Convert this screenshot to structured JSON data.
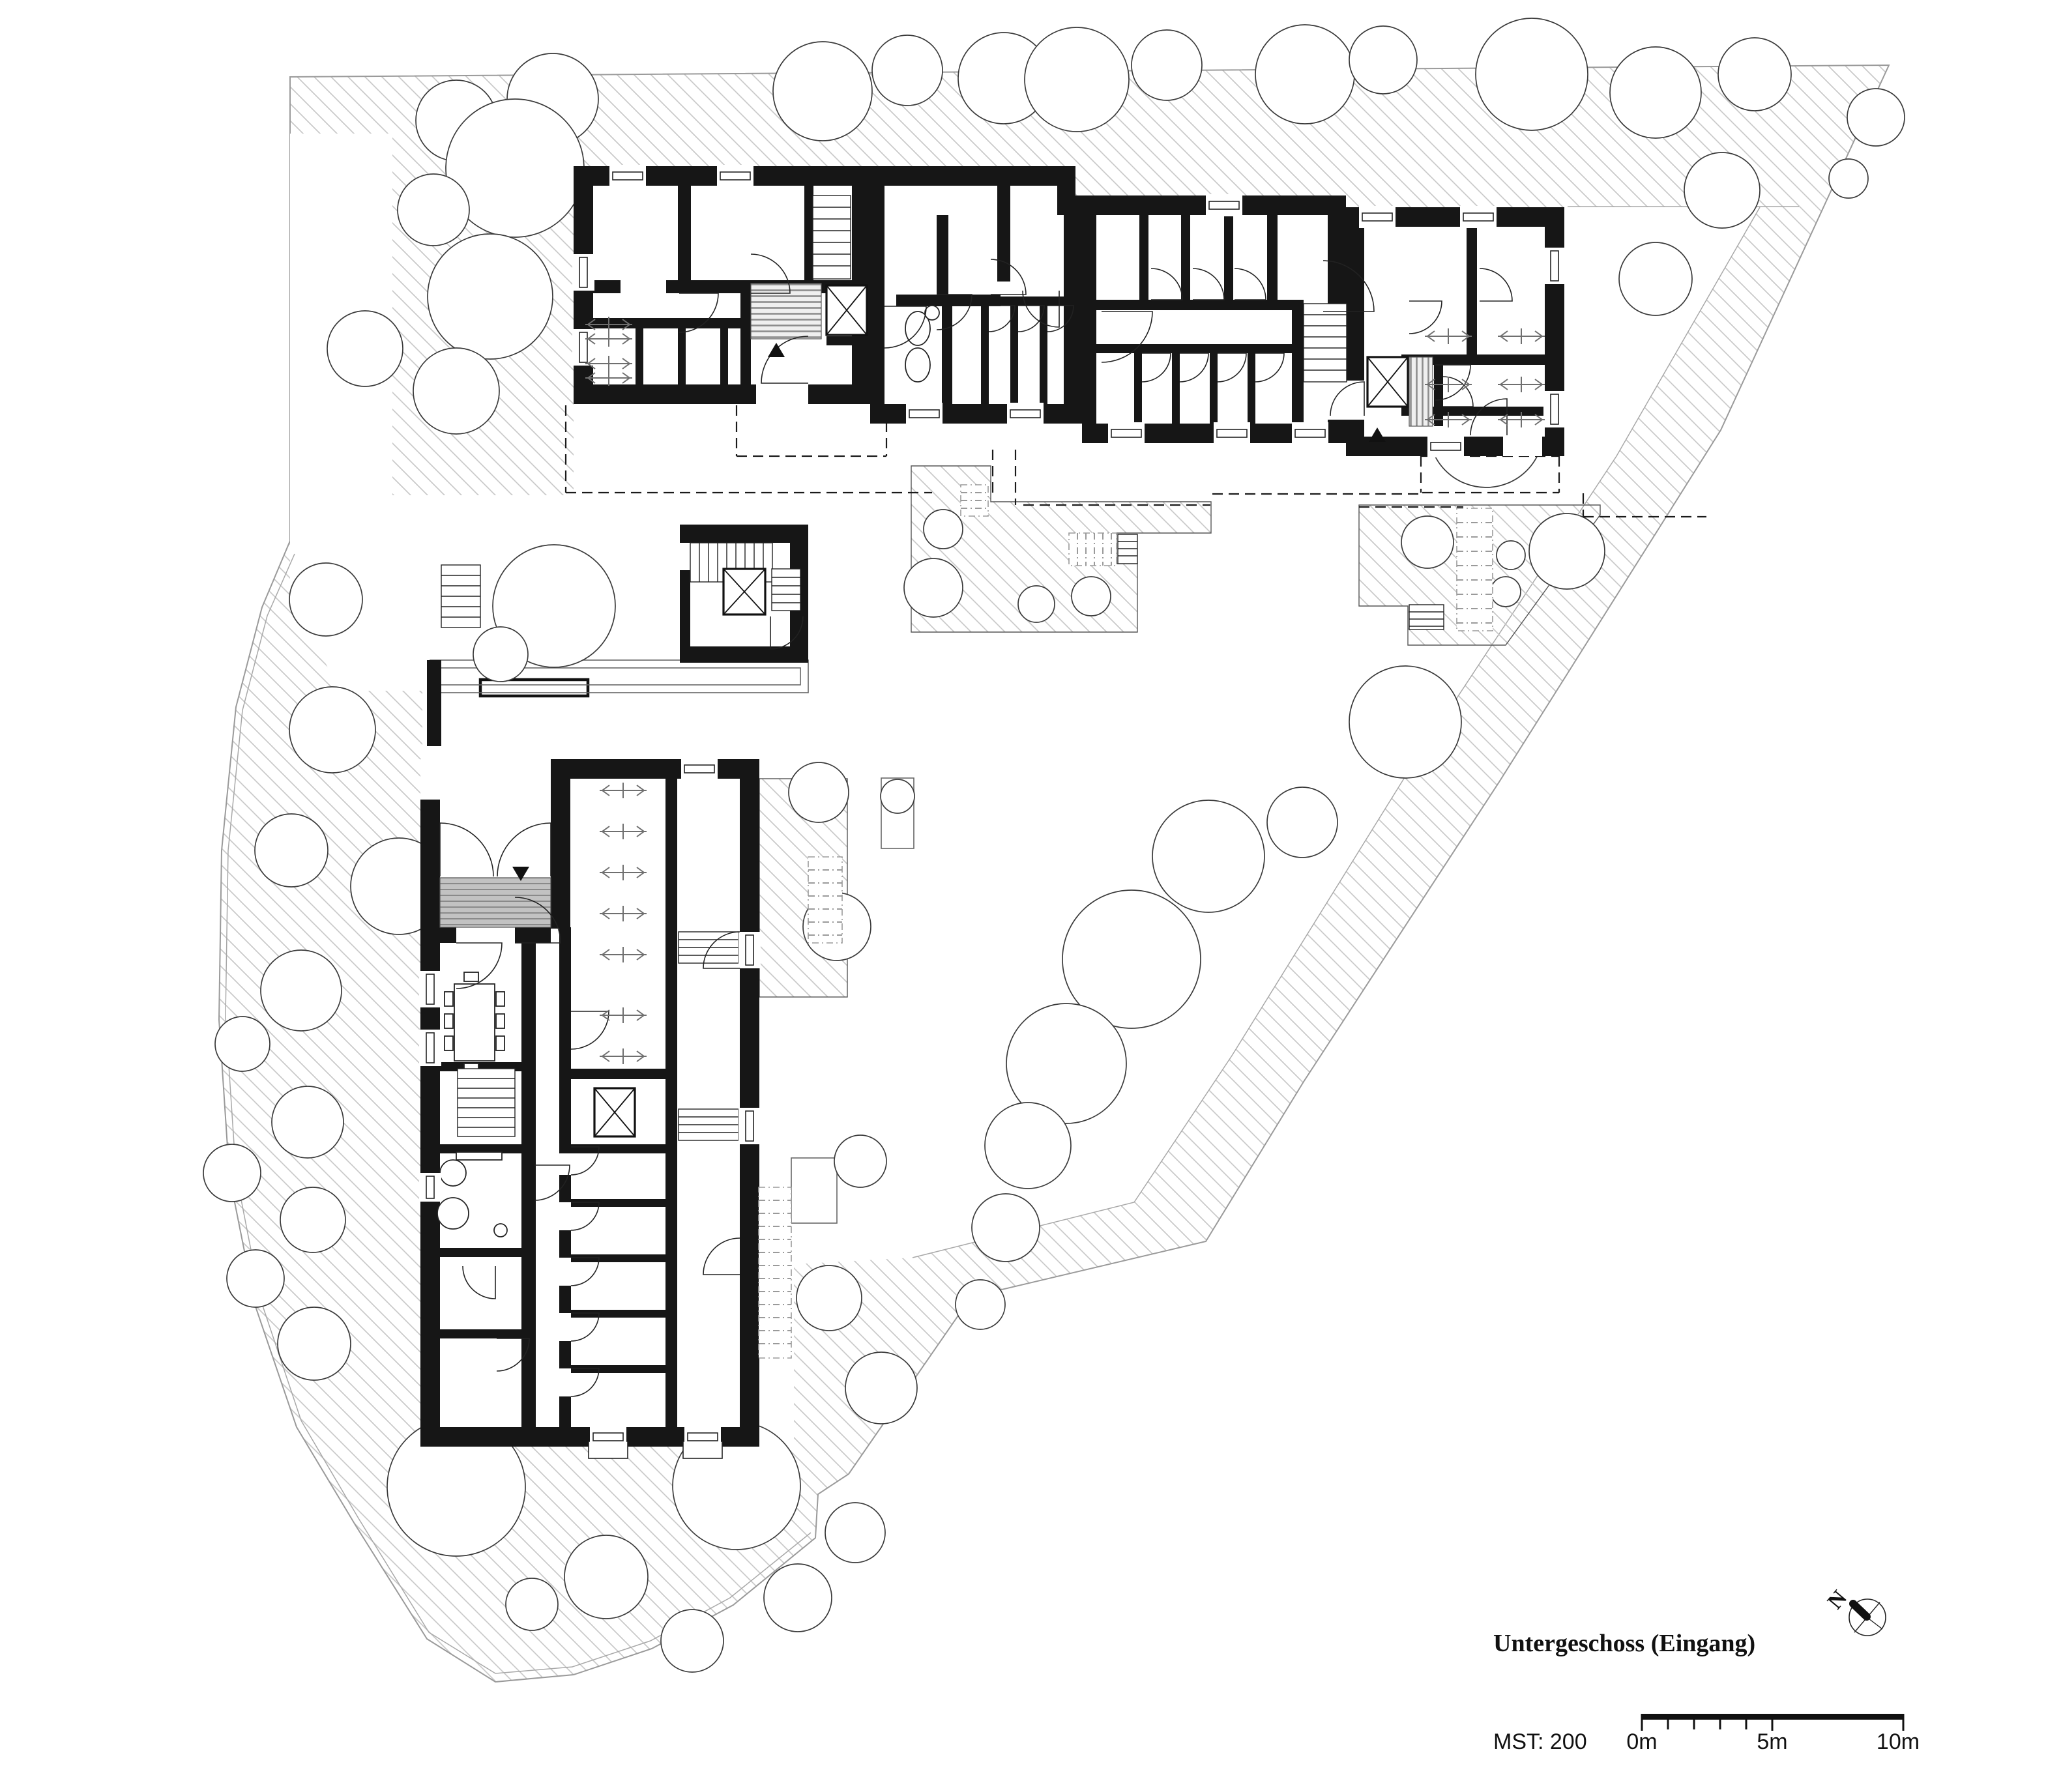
{
  "labels": {
    "floor_title": "Untergeschoss (Eingang)",
    "scale_label": "MST: 200",
    "scale_ticks": [
      "0m",
      "5m",
      "10m"
    ],
    "north_letter": "N"
  },
  "colors": {
    "walls": "#161616",
    "hatch_lines": "#c9c9c9",
    "site_boundary": "#9a9a9a",
    "gray_fill": "#c2c2c2",
    "dashdot_gray": "#9a9a9a",
    "background": "#ffffff"
  },
  "plan": {
    "trees": [
      [
        700,
        185,
        62
      ],
      [
        848,
        152,
        70
      ],
      [
        790,
        258,
        106
      ],
      [
        665,
        322,
        55
      ],
      [
        752,
        455,
        96
      ],
      [
        700,
        600,
        66
      ],
      [
        560,
        535,
        58
      ],
      [
        500,
        920,
        56
      ],
      [
        850,
        930,
        94
      ],
      [
        768,
        1004,
        42
      ],
      [
        1262,
        140,
        76
      ],
      [
        1392,
        108,
        54
      ],
      [
        1540,
        120,
        70
      ],
      [
        1652,
        122,
        80
      ],
      [
        1790,
        100,
        54
      ],
      [
        2002,
        114,
        76
      ],
      [
        2122,
        92,
        52
      ],
      [
        2350,
        114,
        86
      ],
      [
        2540,
        142,
        70
      ],
      [
        2692,
        114,
        56
      ],
      [
        2878,
        180,
        44
      ],
      [
        2836,
        274,
        30
      ],
      [
        510,
        1120,
        66
      ],
      [
        447,
        1305,
        56
      ],
      [
        612,
        1360,
        74
      ],
      [
        462,
        1520,
        62
      ],
      [
        372,
        1602,
        42
      ],
      [
        472,
        1722,
        55
      ],
      [
        356,
        1800,
        44
      ],
      [
        480,
        1872,
        50
      ],
      [
        392,
        1962,
        44
      ],
      [
        482,
        2062,
        56
      ],
      [
        700,
        2282,
        106
      ],
      [
        930,
        2420,
        64
      ],
      [
        816,
        2462,
        40
      ],
      [
        1062,
        2518,
        48
      ],
      [
        1130,
        2280,
        98
      ],
      [
        1224,
        2452,
        52
      ],
      [
        1312,
        2352,
        46
      ],
      [
        1256,
        1216,
        46
      ],
      [
        1284,
        1422,
        52
      ],
      [
        1377,
        1222,
        26
      ],
      [
        1320,
        1782,
        40
      ],
      [
        1272,
        1992,
        50
      ],
      [
        1352,
        2130,
        55
      ],
      [
        2156,
        1108,
        86
      ],
      [
        1998,
        1262,
        54
      ],
      [
        1854,
        1314,
        86
      ],
      [
        1736,
        1472,
        106
      ],
      [
        1636,
        1632,
        92
      ],
      [
        1577,
        1758,
        66
      ],
      [
        1543,
        1884,
        52
      ],
      [
        1504,
        2002,
        38
      ],
      [
        2540,
        428,
        56
      ],
      [
        2642,
        292,
        58
      ],
      [
        2280,
        660,
        88
      ],
      [
        1447,
        812,
        30
      ],
      [
        1432,
        902,
        45
      ],
      [
        1590,
        927,
        28
      ],
      [
        1674,
        915,
        30
      ],
      [
        2190,
        832,
        40
      ],
      [
        2318,
        852,
        22
      ],
      [
        2310,
        908,
        23
      ],
      [
        2404,
        846,
        58
      ]
    ],
    "windows": [
      [
        935,
        255,
        56,
        0
      ],
      [
        1100,
        255,
        56,
        0
      ],
      [
        1850,
        300,
        56,
        0
      ],
      [
        2085,
        318,
        56,
        0
      ],
      [
        2240,
        318,
        56,
        0
      ],
      [
        1390,
        620,
        56,
        0
      ],
      [
        1545,
        620,
        56,
        0
      ],
      [
        1700,
        650,
        56,
        0
      ],
      [
        1862,
        650,
        56,
        0
      ],
      [
        1982,
        650,
        56,
        0
      ],
      [
        2190,
        670,
        56,
        0
      ],
      [
        1045,
        1165,
        56,
        0
      ],
      [
        905,
        2190,
        56,
        0
      ],
      [
        1050,
        2190,
        56,
        0
      ],
      [
        880,
        390,
        56,
        1
      ],
      [
        880,
        505,
        56,
        1
      ],
      [
        645,
        1490,
        56,
        1
      ],
      [
        645,
        1580,
        56,
        1
      ],
      [
        645,
        1800,
        44,
        1
      ],
      [
        2370,
        380,
        56,
        1
      ],
      [
        2370,
        600,
        56,
        1
      ],
      [
        1135,
        1430,
        56,
        1
      ],
      [
        1135,
        1700,
        56,
        1
      ]
    ],
    "doors": [
      [
        1042,
        450,
        60,
        90,
        0
      ],
      [
        1152,
        450,
        60,
        90,
        1
      ],
      [
        1240,
        588,
        72,
        -90,
        0
      ],
      [
        1357,
        470,
        64,
        90,
        0
      ],
      [
        1437,
        452,
        54,
        90,
        0
      ],
      [
        1520,
        452,
        54,
        90,
        1
      ],
      [
        1625,
        446,
        56,
        180,
        0
      ],
      [
        1517,
        469,
        40,
        90,
        0
      ],
      [
        1562,
        469,
        40,
        90,
        0
      ],
      [
        1607,
        469,
        40,
        90,
        0
      ],
      [
        1690,
        478,
        78,
        90,
        0
      ],
      [
        2030,
        478,
        78,
        90,
        1
      ],
      [
        1766,
        460,
        48,
        90,
        1
      ],
      [
        1830,
        460,
        48,
        90,
        1
      ],
      [
        1894,
        460,
        48,
        90,
        1
      ],
      [
        1752,
        542,
        44,
        90,
        0
      ],
      [
        1810,
        542,
        44,
        90,
        0
      ],
      [
        1868,
        542,
        44,
        90,
        0
      ],
      [
        1926,
        542,
        44,
        90,
        0
      ],
      [
        2093,
        638,
        52,
        0,
        1
      ],
      [
        2202,
        560,
        54,
        90,
        0
      ],
      [
        2162,
        462,
        50,
        90,
        0
      ],
      [
        2270,
        462,
        50,
        90,
        1
      ],
      [
        2312,
        668,
        56,
        0,
        1
      ],
      [
        2214,
        624,
        46,
        90,
        1
      ],
      [
        675,
        1345,
        82,
        0,
        0
      ],
      [
        845,
        1345,
        82,
        0,
        1
      ],
      [
        700,
        1447,
        70,
        90,
        0
      ],
      [
        790,
        1447,
        70,
        90,
        1
      ],
      [
        820,
        1788,
        54,
        90,
        0
      ],
      [
        760,
        1943,
        50,
        180,
        0
      ],
      [
        762,
        2054,
        50,
        90,
        0
      ],
      [
        876,
        1760,
        43,
        90,
        0
      ],
      [
        876,
        1845,
        43,
        90,
        0
      ],
      [
        876,
        1930,
        43,
        90,
        0
      ],
      [
        876,
        2015,
        43,
        90,
        0
      ],
      [
        876,
        2100,
        43,
        90,
        0
      ],
      [
        876,
        1552,
        58,
        90,
        0
      ],
      [
        1135,
        1486,
        56,
        -90,
        0
      ],
      [
        1135,
        1956,
        56,
        -90,
        0
      ],
      [
        1182,
        946,
        50,
        180,
        1
      ]
    ],
    "racks": [
      [
        898,
        498
      ],
      [
        898,
        520
      ],
      [
        898,
        558
      ],
      [
        898,
        580
      ],
      [
        2186,
        516
      ],
      [
        2298,
        516
      ],
      [
        2186,
        590
      ],
      [
        2298,
        590
      ],
      [
        2186,
        644
      ],
      [
        2298,
        644
      ],
      [
        920,
        1213
      ],
      [
        920,
        1276
      ],
      [
        920,
        1339
      ],
      [
        920,
        1402
      ],
      [
        920,
        1465
      ],
      [
        920,
        1558
      ],
      [
        920,
        1621
      ]
    ],
    "stairs": [
      [
        1247,
        300,
        58,
        128,
        0,
        18
      ],
      [
        2000,
        466,
        66,
        120,
        0,
        17
      ],
      [
        1059,
        833,
        126,
        60,
        1,
        14
      ],
      [
        1184,
        873,
        44,
        64,
        0,
        13
      ],
      [
        702,
        1640,
        88,
        104,
        0,
        15
      ],
      [
        677,
        867,
        60,
        96,
        0,
        16
      ],
      [
        1041,
        1430,
        92,
        48,
        0,
        12
      ],
      [
        1041,
        1702,
        92,
        48,
        0,
        12
      ],
      [
        1715,
        820,
        30,
        45,
        0,
        11
      ],
      [
        2162,
        928,
        53,
        38,
        0,
        11
      ]
    ],
    "gray_stairs": [
      [
        1640,
        818,
        73,
        50,
        1,
        13
      ],
      [
        2235,
        780,
        55,
        188,
        0,
        22
      ],
      [
        1164,
        1822,
        50,
        262,
        0,
        20
      ],
      [
        1240,
        1315,
        52,
        132,
        0,
        20
      ],
      [
        1474,
        744,
        42,
        48,
        0,
        12
      ]
    ],
    "lifts": [
      [
        1268,
        438,
        62,
        76
      ],
      [
        2098,
        548,
        62,
        76
      ],
      [
        1110,
        873,
        64,
        70
      ],
      [
        912,
        1670,
        62,
        74
      ]
    ],
    "gray_blocks": [
      [
        1152,
        435,
        108,
        85,
        0
      ],
      [
        2162,
        548,
        36,
        106,
        1
      ],
      [
        675,
        1347,
        170,
        76,
        2
      ]
    ],
    "arrows": [
      [
        1178,
        548,
        0
      ],
      [
        2100,
        678,
        0
      ],
      [
        786,
        1330,
        1
      ]
    ],
    "dashes": [
      [
        868,
        622,
        868,
        756
      ],
      [
        868,
        756,
        1430,
        756
      ],
      [
        1570,
        775,
        1857,
        775
      ],
      [
        1523,
        690,
        1523,
        757
      ],
      [
        1558,
        690,
        1558,
        775
      ],
      [
        1860,
        758,
        2178,
        758
      ],
      [
        2180,
        700,
        2180,
        756
      ],
      [
        2180,
        700,
        2392,
        700
      ],
      [
        2392,
        700,
        2392,
        756
      ],
      [
        2182,
        756,
        2392,
        756
      ],
      [
        2429,
        757,
        2429,
        793
      ],
      [
        2429,
        793,
        2618,
        793
      ],
      [
        660,
        1197,
        845,
        1197
      ],
      [
        952,
        438,
        1022,
        438
      ],
      [
        952,
        446,
        1022,
        446
      ],
      [
        2378,
        498,
        2378,
        556
      ],
      [
        2394,
        498,
        2394,
        556
      ],
      [
        1130,
        622,
        1130,
        700
      ],
      [
        1130,
        700,
        1360,
        700
      ],
      [
        1360,
        622,
        1360,
        700
      ],
      [
        2085,
        778,
        2245,
        778
      ]
    ]
  }
}
